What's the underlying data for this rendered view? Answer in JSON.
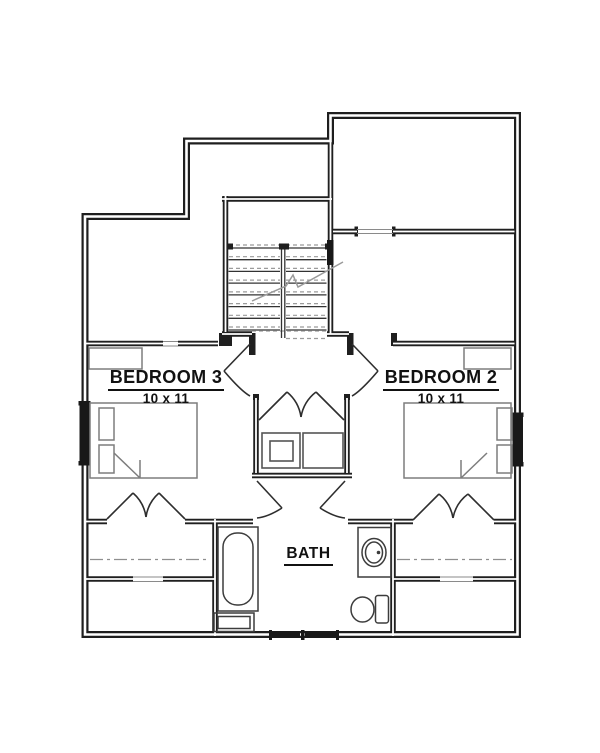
{
  "plan": {
    "rooms": {
      "bedroom3": {
        "label": "BEDROOM 3",
        "dims": "10 x 11"
      },
      "bedroom2": {
        "label": "BEDROOM 2",
        "dims": "10 x 11"
      },
      "bath": {
        "label": "BATH"
      }
    },
    "colors": {
      "background": "#ffffff",
      "wall": "#1f1f1f",
      "fixture": "#3c3c3c",
      "furniture": "#7d7d7d",
      "window_fill": "#181818",
      "dash_grey": "#9b9b9b"
    },
    "symbols": [
      "staircase-up-icon",
      "swing-door-icon",
      "double-closet-door-icon",
      "window-icon",
      "bathtub-icon",
      "toilet-icon",
      "sink-vanity-icon",
      "bed-icon",
      "dresser-icon",
      "closet-shelves-icon",
      "attic-centerline-icon"
    ]
  }
}
